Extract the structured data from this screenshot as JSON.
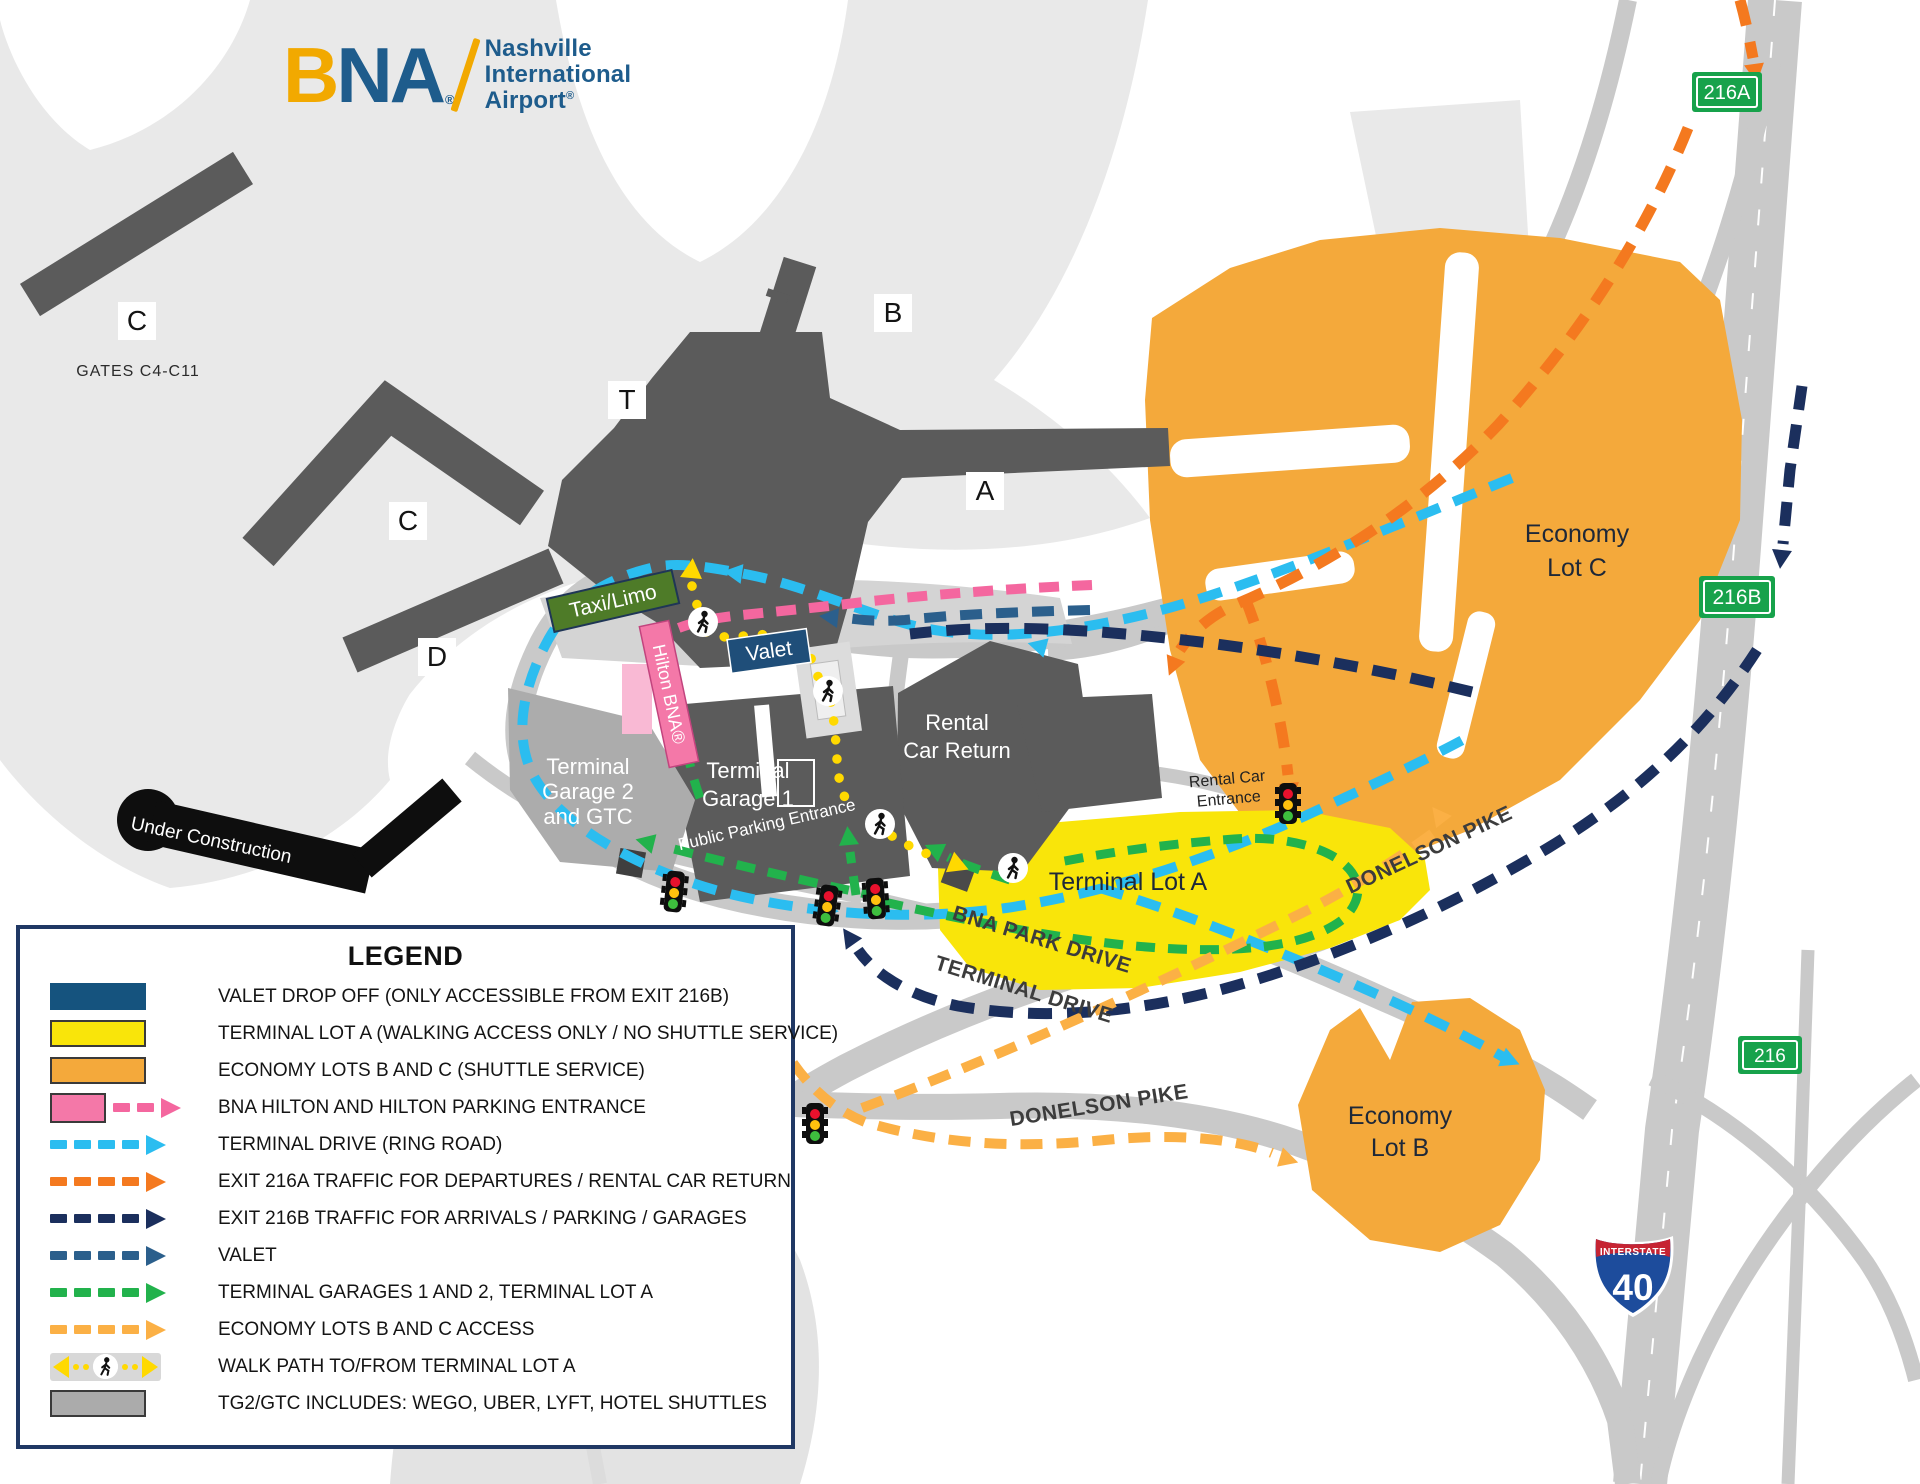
{
  "logo": {
    "b": "B",
    "na": "NA",
    "reg": "®",
    "line1": "Nashville",
    "line2": "International",
    "line3": "Airport"
  },
  "colors": {
    "cyan": "#2BBDF0",
    "orange": "#F4791F",
    "navy": "#1B2F5D",
    "steel": "#2B5F8C",
    "green": "#22B24C",
    "amber": "#FBB045",
    "pink": "#F4679F",
    "walk_yellow": "#FFD900",
    "lot_yellow": "#F9E50A",
    "econ_orange": "#F4A93B",
    "valet_navy": "#15537E",
    "gray_swatch": "#ABABAB",
    "road": "#C9C9C9",
    "road_light": "#DCDCDC",
    "apron": "#E9E9E9",
    "dark": "#5B5B5B",
    "garage_gray": "#ACACAC",
    "ink": "#0E0E0E",
    "sign_green": "#17A24B",
    "shield_red": "#C62433",
    "shield_blue": "#1D4C9C",
    "gold": "#F2A900",
    "logo_blue": "#1E5C8C",
    "tag_green": "#4E7B28",
    "tag_navy": "#1F4E79",
    "hilton_pink": "#F478A8",
    "tl_red": "#E8112D",
    "tl_amber": "#FFC10E",
    "tl_green": "#3EBE3E"
  },
  "map": {
    "labels": {
      "c1": "C",
      "gates": "GATES C4-C11",
      "c2": "C",
      "t": "T",
      "b": "B",
      "a": "A",
      "d": "D",
      "under_construction": "Under Construction",
      "tg2_1": "Terminal",
      "tg2_2": "Garage 2",
      "tg2_3": "and GTC",
      "tg1_1": "Terminal",
      "tg1_2": "Garage 1",
      "rcr_1": "Rental",
      "rcr_2": "Car Return",
      "lot_a": "Terminal Lot A",
      "econ_c_1": "Economy",
      "econ_c_2": "Lot C",
      "econ_b_1": "Economy",
      "econ_b_2": "Lot B",
      "taxi": "Taxi/Limo",
      "valet": "Valet",
      "hilton": "Hilton BNA®",
      "public_parking": "Public Parking Entrance",
      "rental_entrance_1": "Rental Car",
      "rental_entrance_2": "Entrance",
      "bna_park": "BNA PARK DRIVE",
      "terminal_drive": "TERMINAL DRIVE",
      "donelson_1": "DONELSON PIKE",
      "donelson_2": "DONELSON PIKE",
      "exit_216a": "216A",
      "exit_216b": "216B",
      "exit_216": "216",
      "interstate": "INTERSTATE",
      "i40": "40"
    }
  },
  "legend": {
    "title": "LEGEND",
    "items": [
      {
        "symbol": "navy-swatch",
        "label": "VALET DROP OFF (ONLY ACCESSIBLE FROM EXIT 216B)"
      },
      {
        "symbol": "yellow-swatch",
        "label": "TERMINAL LOT A (WALKING ACCESS ONLY / NO SHUTTLE SERVICE)"
      },
      {
        "symbol": "orange-swatch",
        "label": "ECONOMY LOTS B AND C (SHUTTLE SERVICE)"
      },
      {
        "symbol": "pink-swatch-arrow",
        "label": "BNA HILTON AND HILTON PARKING ENTRANCE"
      },
      {
        "symbol": "cyan-dashed-arrow",
        "label": "TERMINAL DRIVE (RING ROAD)"
      },
      {
        "symbol": "orange-dashed-arrow",
        "label": "EXIT 216A TRAFFIC FOR DEPARTURES / RENTAL CAR RETURN"
      },
      {
        "symbol": "navy-dashed-arrow",
        "label": "EXIT 216B TRAFFIC FOR ARRIVALS / PARKING / GARAGES"
      },
      {
        "symbol": "steel-dashed-arrow",
        "label": "VALET"
      },
      {
        "symbol": "green-dashed-arrow",
        "label": "TERMINAL GARAGES 1 AND 2, TERMINAL LOT A"
      },
      {
        "symbol": "amber-dashed-arrow",
        "label": "ECONOMY LOTS B AND C ACCESS"
      },
      {
        "symbol": "walk-path",
        "label": "WALK PATH TO/FROM TERMINAL LOT A"
      },
      {
        "symbol": "gray-swatch",
        "label": "TG2/GTC INCLUDES: WEGO, UBER, LYFT, HOTEL SHUTTLES"
      }
    ]
  }
}
